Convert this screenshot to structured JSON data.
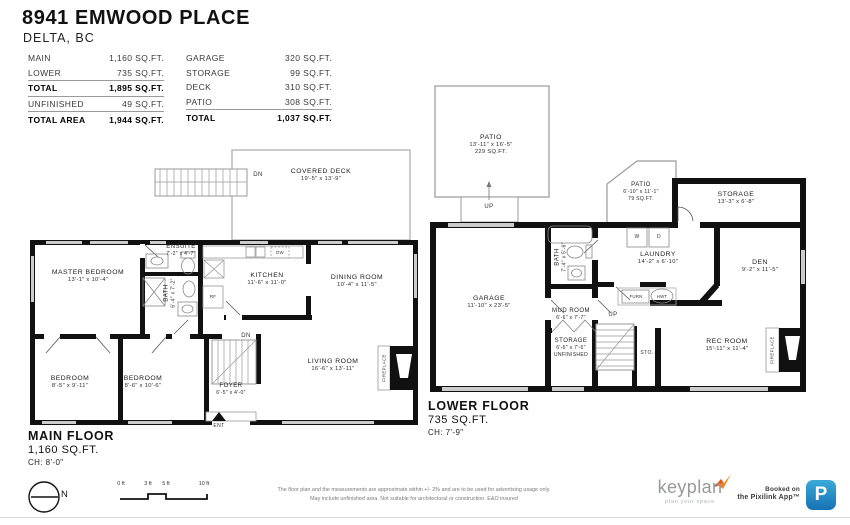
{
  "header": {
    "title": "8941 EMWOOD PLACE",
    "subtitle": "DELTA, BC"
  },
  "area_table": {
    "left": [
      {
        "label": "MAIN",
        "value": "1,160 SQ.FT."
      },
      {
        "label": "LOWER",
        "value": "735 SQ.FT."
      },
      {
        "label": "TOTAL",
        "value": "1,895 SQ.FT."
      },
      {
        "label": "UNFINISHED",
        "value": "49 SQ.FT."
      },
      {
        "label": "TOTAL AREA",
        "value": "1,944 SQ.FT."
      }
    ],
    "right": [
      {
        "label": "GARAGE",
        "value": "320 SQ.FT."
      },
      {
        "label": "STORAGE",
        "value": "99 SQ.FT."
      },
      {
        "label": "DECK",
        "value": "310 SQ.FT."
      },
      {
        "label": "PATIO",
        "value": "308 SQ.FT."
      },
      {
        "label": "TOTAL",
        "value": "1,037 SQ.FT."
      }
    ]
  },
  "floors": {
    "main": {
      "title": "MAIN FLOOR",
      "area": "1,160 SQ.FT.",
      "ceiling": "CH: 8'-0\"",
      "rooms": {
        "covered_deck": {
          "name": "COVERED DECK",
          "dims": "19'-5\" x 13'-9\""
        },
        "master": {
          "name": "MASTER BEDROOM",
          "dims": "13'-1\" x 10'-4\""
        },
        "ensuite": {
          "name": "ENSUITE",
          "dims": "7'-2\" x 4'-7\""
        },
        "bath": {
          "name": "BATH",
          "dims": "6'-4\" x 7'-2\""
        },
        "kitchen": {
          "name": "KITCHEN",
          "dims": "11'-6\" x 11'-0\""
        },
        "dining": {
          "name": "DINING ROOM",
          "dims": "10'-4\" x 11'-5\""
        },
        "bedroom1": {
          "name": "BEDROOM",
          "dims": "8'-5\" x 9'-11\""
        },
        "bedroom2": {
          "name": "BEDROOM",
          "dims": "8'-6\" x 10'-6\""
        },
        "foyer": {
          "name": "FOYER",
          "dims": "6'-5\" x 4'-0\""
        },
        "living": {
          "name": "LIVING ROOM",
          "dims": "16'-6\" x 13'-11\""
        }
      }
    },
    "lower": {
      "title": "LOWER FLOOR",
      "area": "735 SQ.FT.",
      "ceiling": "CH: 7'-9\"",
      "rooms": {
        "patio_large": {
          "name": "PATIO",
          "dims": "13'-11\" x 16'-5\"",
          "extra": "229 SQ.FT."
        },
        "patio_small": {
          "name": "PATIO",
          "dims": "6'-10\" x 11'-1\"",
          "extra": "79 SQ.FT."
        },
        "storage_upper": {
          "name": "STORAGE",
          "dims": "13'-3\" x 6'-8\""
        },
        "laundry": {
          "name": "LAUNDRY",
          "dims": "14'-2\" x 6'-10\""
        },
        "den": {
          "name": "DEN",
          "dims": "9'-2\" x 11'-5\""
        },
        "garage": {
          "name": "GARAGE",
          "dims": "11'-10\" x 23'-5\""
        },
        "bath": {
          "name": "BATH",
          "dims": "7'-4\" x 5'-6\""
        },
        "mud_room": {
          "name": "MUD ROOM",
          "dims": "6'-6\" x 7'-7\""
        },
        "storage_lower": {
          "name": "STORAGE",
          "dims": "6'-6\" x 7'-6\"",
          "extra": "UNFINISHED"
        },
        "rec_room": {
          "name": "REC ROOM",
          "dims": "15'-11\" x 11'-4\""
        }
      }
    }
  },
  "annotations": {
    "dn": "DN",
    "up": "UP",
    "ent": "ENT",
    "sto": "STO.",
    "rf": "RF",
    "dw": "DW",
    "washer": "W",
    "dryer": "D",
    "furnace": "FURN",
    "hot_water_tank": "HWT",
    "fireplace": "FIREPLACE",
    "north": "N"
  },
  "scale_bar": {
    "labels": [
      "0 ft",
      "3 ft",
      "5 ft",
      "10 ft"
    ]
  },
  "footer": {
    "disclaimer_line1": "The floor plan and the measurements are approximate within +/- 2% and are to be used for advertising usage only.",
    "disclaimer_line2": "May include unfinished area. Not suitable for architectural or construction. E&O insured",
    "brand_name": "keyplan",
    "brand_tagline": "plan your space",
    "booked_line1": "Booked on",
    "booked_line2": "the Pixilink App™",
    "app_icon_letter": "P"
  },
  "colors": {
    "wall": "#111111",
    "brand_orange": "#f58220",
    "app_blue": "#1b7fc4"
  }
}
